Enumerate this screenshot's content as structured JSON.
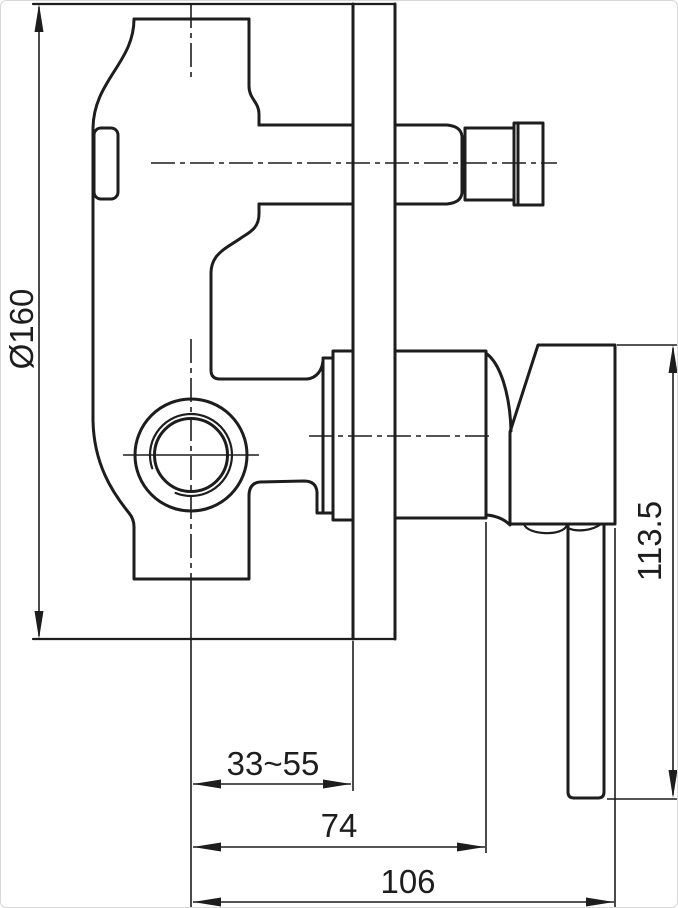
{
  "drawing": {
    "description": "Concealed single-lever shower mixer valve - side elevation technical drawing",
    "view": "side elevation",
    "background_color": "#ffffff",
    "line_color": "#1d1d1d",
    "frame_color": "#d8d8d8"
  },
  "dimension_labels": {
    "plate_diameter": "Ø160",
    "handle_height": "113.5",
    "adjustable_depth": "33~55",
    "trim_depth": "74",
    "overall_depth": "106"
  },
  "dimensions_info": [
    {
      "name": "escutcheon-plate-diameter",
      "label": "Ø160",
      "orientation": "vertical-left"
    },
    {
      "name": "handle-overall-height",
      "label": "113.5",
      "orientation": "vertical-right"
    },
    {
      "name": "wall-adjustable-depth",
      "label": "33~55",
      "orientation": "horizontal-bottom"
    },
    {
      "name": "depth-to-trim-face",
      "label": "74",
      "orientation": "horizontal-bottom"
    },
    {
      "name": "overall-depth",
      "label": "106",
      "orientation": "horizontal-bottom"
    }
  ]
}
